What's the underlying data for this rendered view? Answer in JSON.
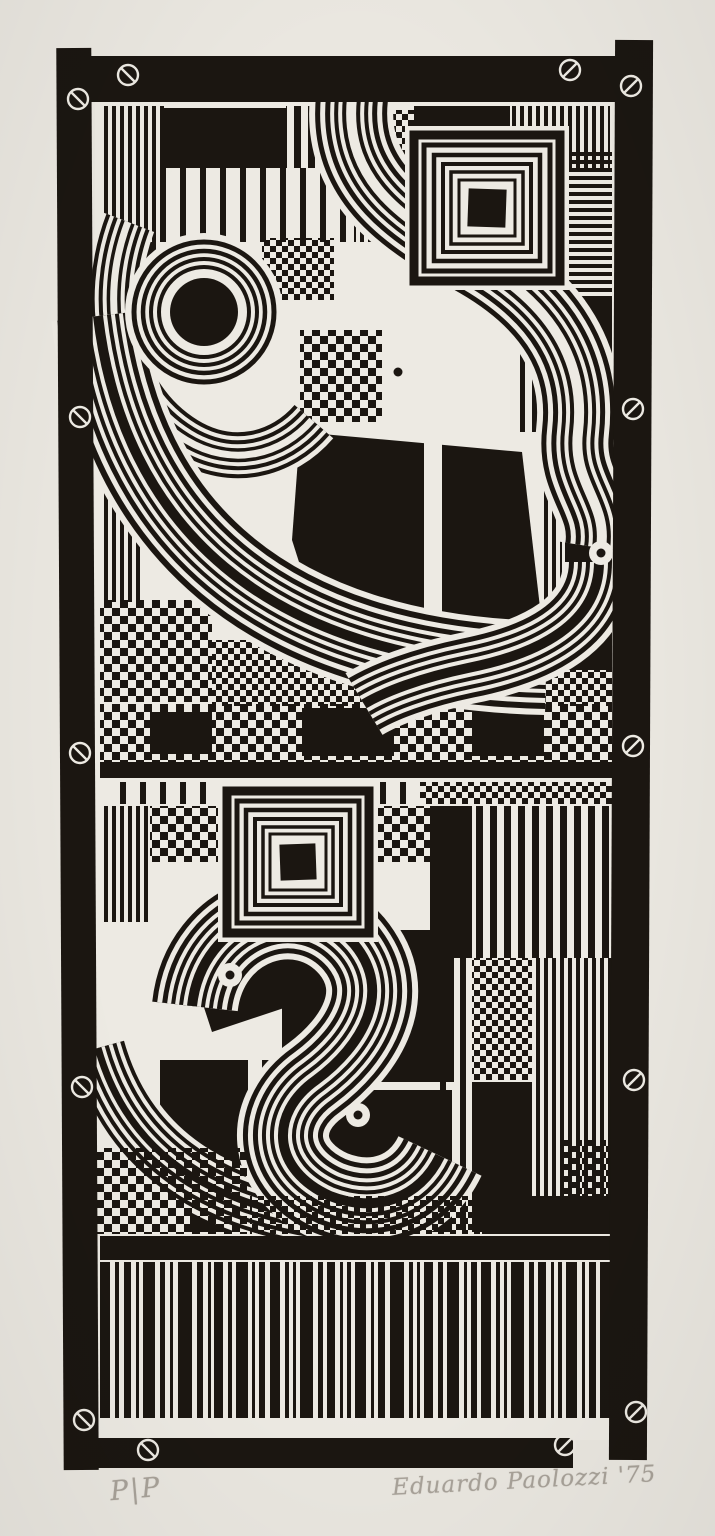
{
  "colors": {
    "ink": "#1b1611",
    "print_paper": "#edeae3",
    "sheet_margin": "#eae7e0",
    "pencil": "#a8a299"
  },
  "inscriptions": {
    "edition": "P|P",
    "signature": "Eduardo Paolozzi '75"
  },
  "frame": {
    "screws": [
      {
        "x": 128,
        "y": 75
      },
      {
        "x": 570,
        "y": 70
      },
      {
        "x": 78,
        "y": 99
      },
      {
        "x": 631,
        "y": 86
      },
      {
        "x": 80,
        "y": 417
      },
      {
        "x": 633,
        "y": 409
      },
      {
        "x": 80,
        "y": 753
      },
      {
        "x": 633,
        "y": 746
      },
      {
        "x": 82,
        "y": 1087
      },
      {
        "x": 634,
        "y": 1080
      },
      {
        "x": 84,
        "y": 1420
      },
      {
        "x": 636,
        "y": 1412
      },
      {
        "x": 148,
        "y": 1450
      },
      {
        "x": 565,
        "y": 1445
      }
    ]
  },
  "barcode": {
    "y": 1262,
    "height": 156,
    "bars": [
      [
        100,
        10
      ],
      [
        115,
        4
      ],
      [
        124,
        7
      ],
      [
        136,
        3
      ],
      [
        143,
        12
      ],
      [
        160,
        5
      ],
      [
        170,
        3
      ],
      [
        178,
        14
      ],
      [
        197,
        6
      ],
      [
        208,
        3
      ],
      [
        214,
        9
      ],
      [
        228,
        4
      ],
      [
        236,
        12
      ],
      [
        252,
        3
      ],
      [
        259,
        6
      ],
      [
        270,
        10
      ],
      [
        285,
        4
      ],
      [
        293,
        3
      ],
      [
        300,
        13
      ],
      [
        318,
        5
      ],
      [
        327,
        8
      ],
      [
        340,
        3
      ],
      [
        347,
        4
      ],
      [
        355,
        11
      ],
      [
        371,
        3
      ],
      [
        378,
        7
      ],
      [
        390,
        14
      ],
      [
        409,
        4
      ],
      [
        417,
        3
      ],
      [
        424,
        9
      ],
      [
        438,
        5
      ],
      [
        447,
        12
      ],
      [
        464,
        3
      ],
      [
        471,
        6
      ],
      [
        481,
        10
      ],
      [
        496,
        4
      ],
      [
        504,
        3
      ],
      [
        511,
        13
      ],
      [
        529,
        5
      ],
      [
        538,
        8
      ],
      [
        551,
        3
      ],
      [
        558,
        4
      ],
      [
        566,
        11
      ],
      [
        582,
        3
      ],
      [
        589,
        7
      ],
      [
        600,
        10
      ]
    ]
  },
  "bands": [
    {
      "name": "bottom-left-smile",
      "start": "paper",
      "widths": [
        64,
        54,
        46,
        38,
        30,
        22,
        14,
        7
      ],
      "d": "M98,1048 C130,1162 224,1218 384,1226"
    },
    {
      "name": "arc-around-circle",
      "start": "paper",
      "widths": [
        56,
        46,
        38,
        30,
        22,
        14,
        7
      ],
      "d": "M128,222 C98,300 114,396 186,440 C232,468 282,455 312,420"
    },
    {
      "name": "big-smile",
      "start": "paper",
      "widths": [
        94,
        82,
        70,
        60,
        50,
        42,
        34,
        26,
        18,
        10
      ],
      "d": "M98,316 C122,522 262,662 546,668"
    },
    {
      "name": "upper-s-curve",
      "start": "paper",
      "widths": [
        84,
        72,
        62,
        52,
        42,
        34,
        26,
        18,
        10
      ],
      "d": "M352,98 C342,190 420,228 478,262 C552,305 586,362 578,432 C572,484 608,502 601,548"
    },
    {
      "name": "right-hook",
      "start": "paper",
      "widths": [
        72,
        60,
        50,
        42,
        34,
        26,
        18,
        10
      ],
      "d": "M599,562 C599,624 538,654 468,668 C420,678 384,692 364,704"
    },
    {
      "name": "two-shape",
      "start": "paper",
      "widths": [
        92,
        80,
        70,
        60,
        50,
        42,
        34,
        26,
        18,
        10
      ],
      "d": "M192,1006 C202,916 302,884 354,944 C394,992 362,1046 316,1080 C268,1114 272,1170 330,1196 C376,1214 420,1198 440,1156"
    }
  ],
  "ring_motifs": [
    {
      "cx": 204,
      "cy": 312,
      "radii": [
        70,
        61,
        53,
        45
      ],
      "strokes": [
        5,
        4.5,
        4,
        4
      ],
      "core": 34
    }
  ],
  "square_motifs": [
    {
      "cx": 487,
      "cy": 208,
      "sizes": [
        146,
        126,
        106,
        88,
        72,
        56
      ],
      "strokes": [
        9,
        5,
        4.5,
        4,
        3.5,
        3
      ],
      "core": 38,
      "tilt": 2
    },
    {
      "cx": 298,
      "cy": 862,
      "sizes": [
        142,
        122,
        104,
        86,
        70,
        56
      ],
      "strokes": [
        9,
        5,
        4.5,
        4,
        3.5,
        3
      ],
      "core": 36,
      "tilt": -2
    }
  ],
  "eyes": [
    [
      398,
      372
    ],
    [
      601,
      553
    ],
    [
      230,
      975
    ],
    [
      358,
      1115
    ]
  ]
}
